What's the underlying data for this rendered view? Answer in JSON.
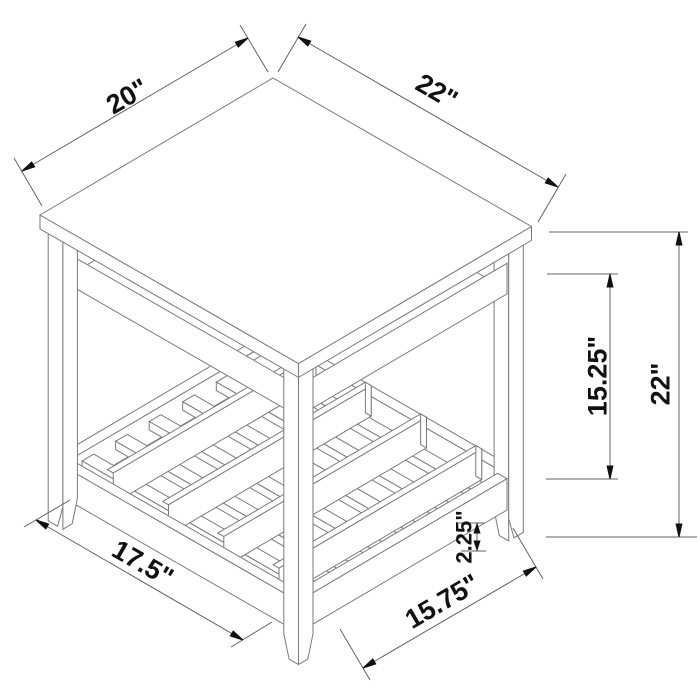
{
  "diagram": {
    "subject": "Isometric dimension drawing of a square end table with slatted lower shelf",
    "labels": {
      "top_left": "20\"",
      "top_right": "22\"",
      "inner_height": "15.25\"",
      "overall_height": "22\"",
      "bottom_left": "17.5\"",
      "bottom_right": "15.75\"",
      "shelf_rail": "2.25\""
    },
    "colors": {
      "background": "#ffffff",
      "structure_line": "#7a7a7a",
      "dimension_line": "#636363",
      "arrow": "#111111",
      "label_text": "#111111"
    }
  }
}
